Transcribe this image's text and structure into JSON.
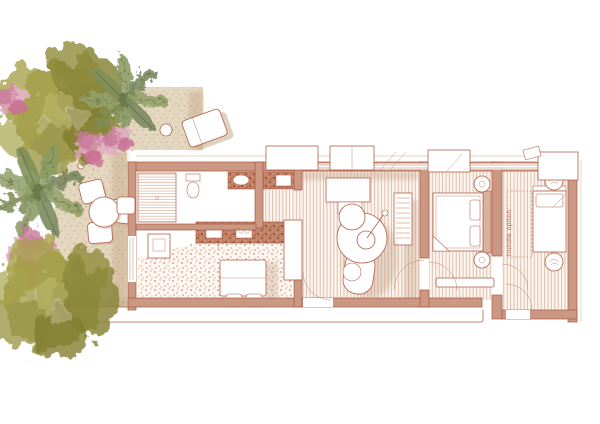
{
  "plan": {
    "trundle_label": "trundle option",
    "rooms": [
      "garden-terrace",
      "bathroom",
      "kitchen",
      "dining-area",
      "living-room",
      "master-bedroom",
      "trundle-room",
      "entry-hall"
    ],
    "garden": {
      "trees": [
        "olive-tree",
        "palm-tree",
        "bougainvillea",
        "palm-tree",
        "bougainvillea",
        "olive-tree"
      ]
    },
    "furniture": [
      "sun-lounger",
      "side-table",
      "outdoor-table-chairs",
      "shower",
      "toilet",
      "vanity-sink",
      "double-vanity",
      "kitchen-counter",
      "oven",
      "dining-table",
      "tv-console",
      "curved-sofa",
      "coffee-table",
      "floor-lamp",
      "louvered-unit",
      "double-bed",
      "nightstand-lamps",
      "bedroom-bench",
      "single-bed",
      "planters"
    ]
  },
  "palette": {
    "line": "#b2604a",
    "wall_fill": "#cb9883",
    "sand": "#e4d7bf",
    "sand_shadow": "#c8ab8f",
    "terrazzo_dot": "#cf8a6d",
    "wood_stripe": "#dcb39e",
    "counter": "#c08165",
    "olive_green": "#96923f",
    "palm_green": "#8a9a63",
    "bougainvillea_pink": "#d996b2",
    "white": "#ffffff"
  }
}
